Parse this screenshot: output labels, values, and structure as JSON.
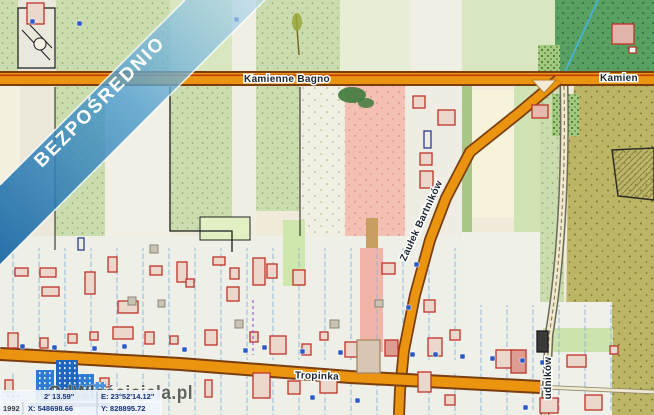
{
  "banner": {
    "text": "BEZPOŚREDNIO"
  },
  "roads": {
    "kamienne_bagno": "Kamienne Bagno",
    "kamienne_bagno_east": "Kamien",
    "tropinka": "Tropinka",
    "zaulek_bartnikow": "Zaułek Bartników",
    "udnikow_fragment": "udników"
  },
  "watermark": {
    "text": "OdWłaściciela.pl"
  },
  "coordinates_bar": {
    "crs": "1992",
    "x_value": "X: 548698.66",
    "y_value": "Y: 828895.72",
    "lat_fragment": "2' 13.59\"",
    "lon_value": "E: 23°52'14.12\""
  },
  "colors": {
    "ribbon_dark": "#1565a3",
    "ribbon_light": "#b9dcee",
    "road_orange": "#ea9410",
    "road_casing": "#7a3e10",
    "building_outline": "#c03228",
    "parcel_line_blue": "#93b7d8",
    "forest_green": "#59a163",
    "field_sage": "#cbdcae",
    "khaki_olive": "#bdb566",
    "pink_zone": "#f4c0b4",
    "marker_blue": "#2b59c8",
    "bar_text_navy": "#16327c"
  }
}
